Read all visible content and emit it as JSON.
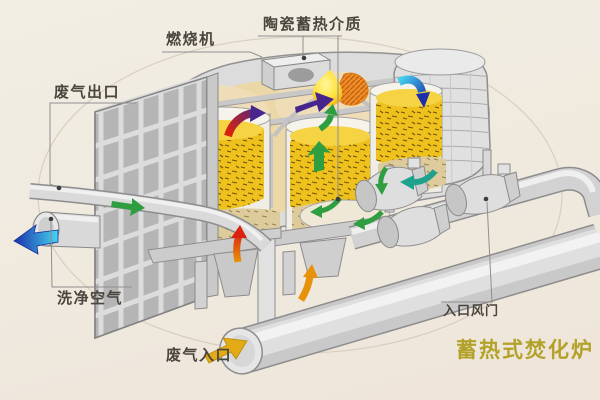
{
  "title": {
    "text": "蓄热式焚化炉",
    "color": "#b3a22a"
  },
  "labels": {
    "ceramic_media": "陶瓷蓄热介质",
    "burner": "燃烧机",
    "exhaust_outlet": "废气出口",
    "clean_air": "洗净空气",
    "exhaust_inlet": "废气入口",
    "inlet_damper": "入口风门"
  },
  "colors": {
    "background": "#f0ebe1",
    "label_text": "#4a453d",
    "leader_line": "#8f8f8f",
    "green": "#2f9e41",
    "red": "#d9230f",
    "purple": "#46268d",
    "orange": "#e8920a",
    "yellow": "#e2aa14",
    "teal": "#1ea28e",
    "blue_light": "#45d4f0",
    "blue_dark": "#1b2fa8",
    "media_gold": "#eec11c",
    "media_gold_top": "#f6d343",
    "media_tan": "#ddcb9b",
    "flame_yellow": "#ffe23a",
    "flame_orange": "#ee8c28",
    "metal_light": "#dcdcdc",
    "metal_mid": "#c6c6c6",
    "metal_dark": "#8d8d8d"
  },
  "flow_arrows": [
    {
      "name": "waste-gas-inlet-arrow",
      "color": "#e2aa14",
      "direction": "up-right"
    },
    {
      "name": "clean-air-outlet-arrow",
      "color": "#45d4f0 to #1b2fa8",
      "direction": "left"
    },
    {
      "name": "duct-flow-arrow",
      "color": "#2f9e41",
      "direction": "right"
    },
    {
      "name": "riser-flow-arrow",
      "color": "#e8920a",
      "direction": "up"
    },
    {
      "name": "bed1-rising-arrow",
      "color": "#d9230f",
      "direction": "up"
    },
    {
      "name": "bed1-top-curve-arrow",
      "color": "#d9230f to #46268d",
      "direction": "up-right"
    },
    {
      "name": "combustion-arrow",
      "color": "#46268d",
      "direction": "right"
    },
    {
      "name": "flame-feed-arrow",
      "color": "#2f9e41",
      "direction": "up"
    },
    {
      "name": "bed2-rising-arrow",
      "color": "#2f9e41",
      "direction": "up"
    },
    {
      "name": "bed2-circulation-arrow-1",
      "color": "#2f9e41",
      "direction": "down-left"
    },
    {
      "name": "bed2-circulation-arrow-2",
      "color": "#2f9e41",
      "direction": "left"
    },
    {
      "name": "bed3-down-arrow",
      "color": "#45d4f0 to #1b2fa8",
      "direction": "down-right"
    },
    {
      "name": "bed3-bottom-arrow",
      "color": "#1ea28e",
      "direction": "left"
    },
    {
      "name": "bed3-small-arrow",
      "color": "#2f9e41",
      "direction": "down"
    }
  ]
}
